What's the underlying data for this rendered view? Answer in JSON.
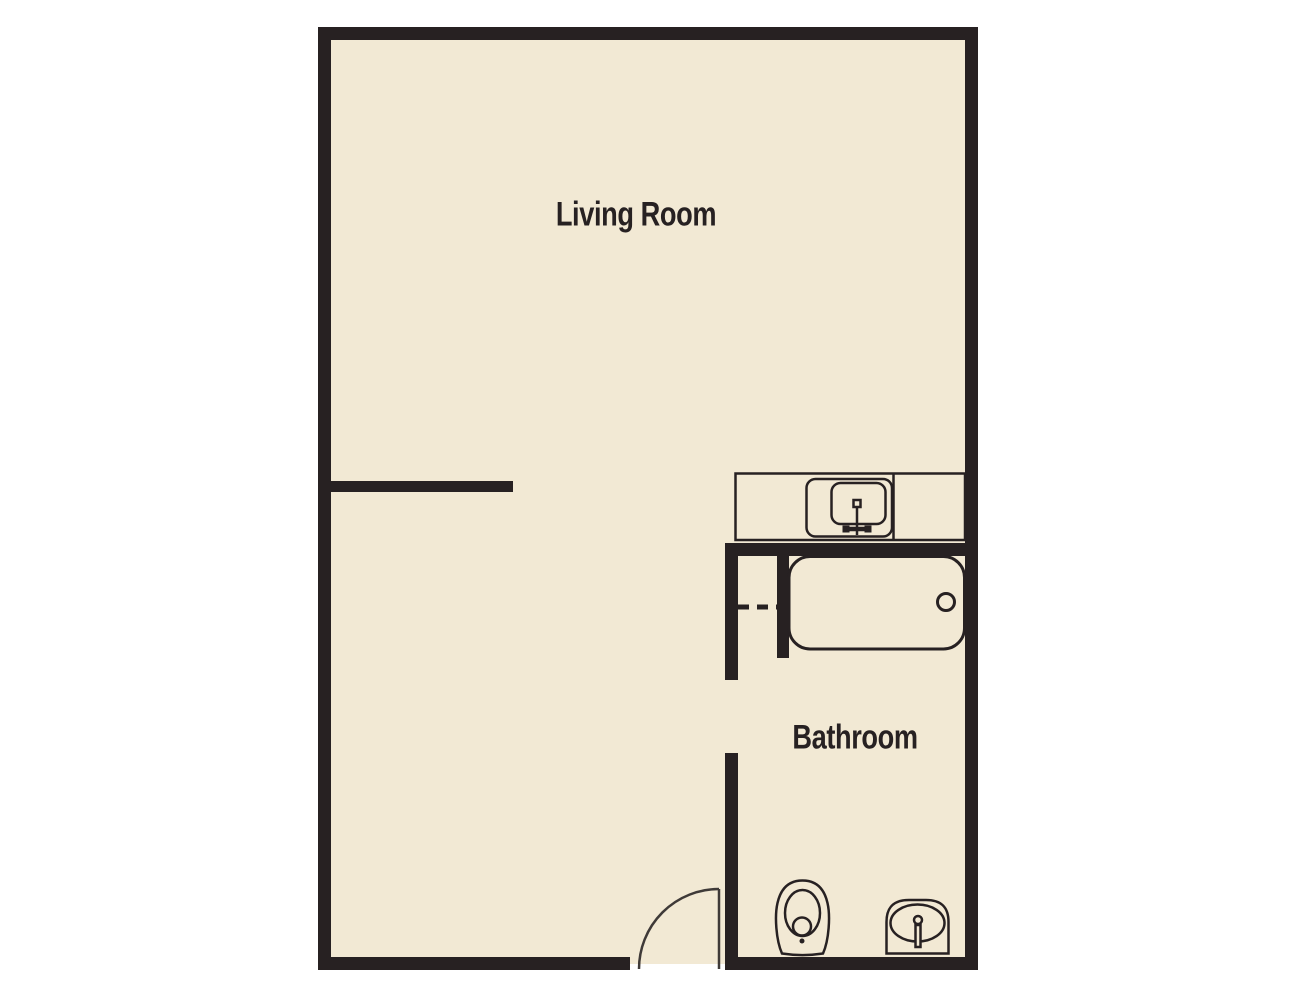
{
  "title": "Apartment floor plan",
  "colors": {
    "wall": "#272122",
    "floor": "#f2e9d4",
    "background": "#ffffff",
    "door": "#3f3a38"
  },
  "rooms": {
    "living_room": {
      "label": "Living Room"
    },
    "bathroom": {
      "label": "Bathroom"
    }
  },
  "fixtures": [
    "kitchen-counter",
    "kitchen-sink",
    "kitchen-faucet",
    "bathtub",
    "bathtub-drain",
    "bathroom-doorway-dashed-opening",
    "toilet",
    "bathroom-sink",
    "sink-faucet",
    "entry-door"
  ]
}
